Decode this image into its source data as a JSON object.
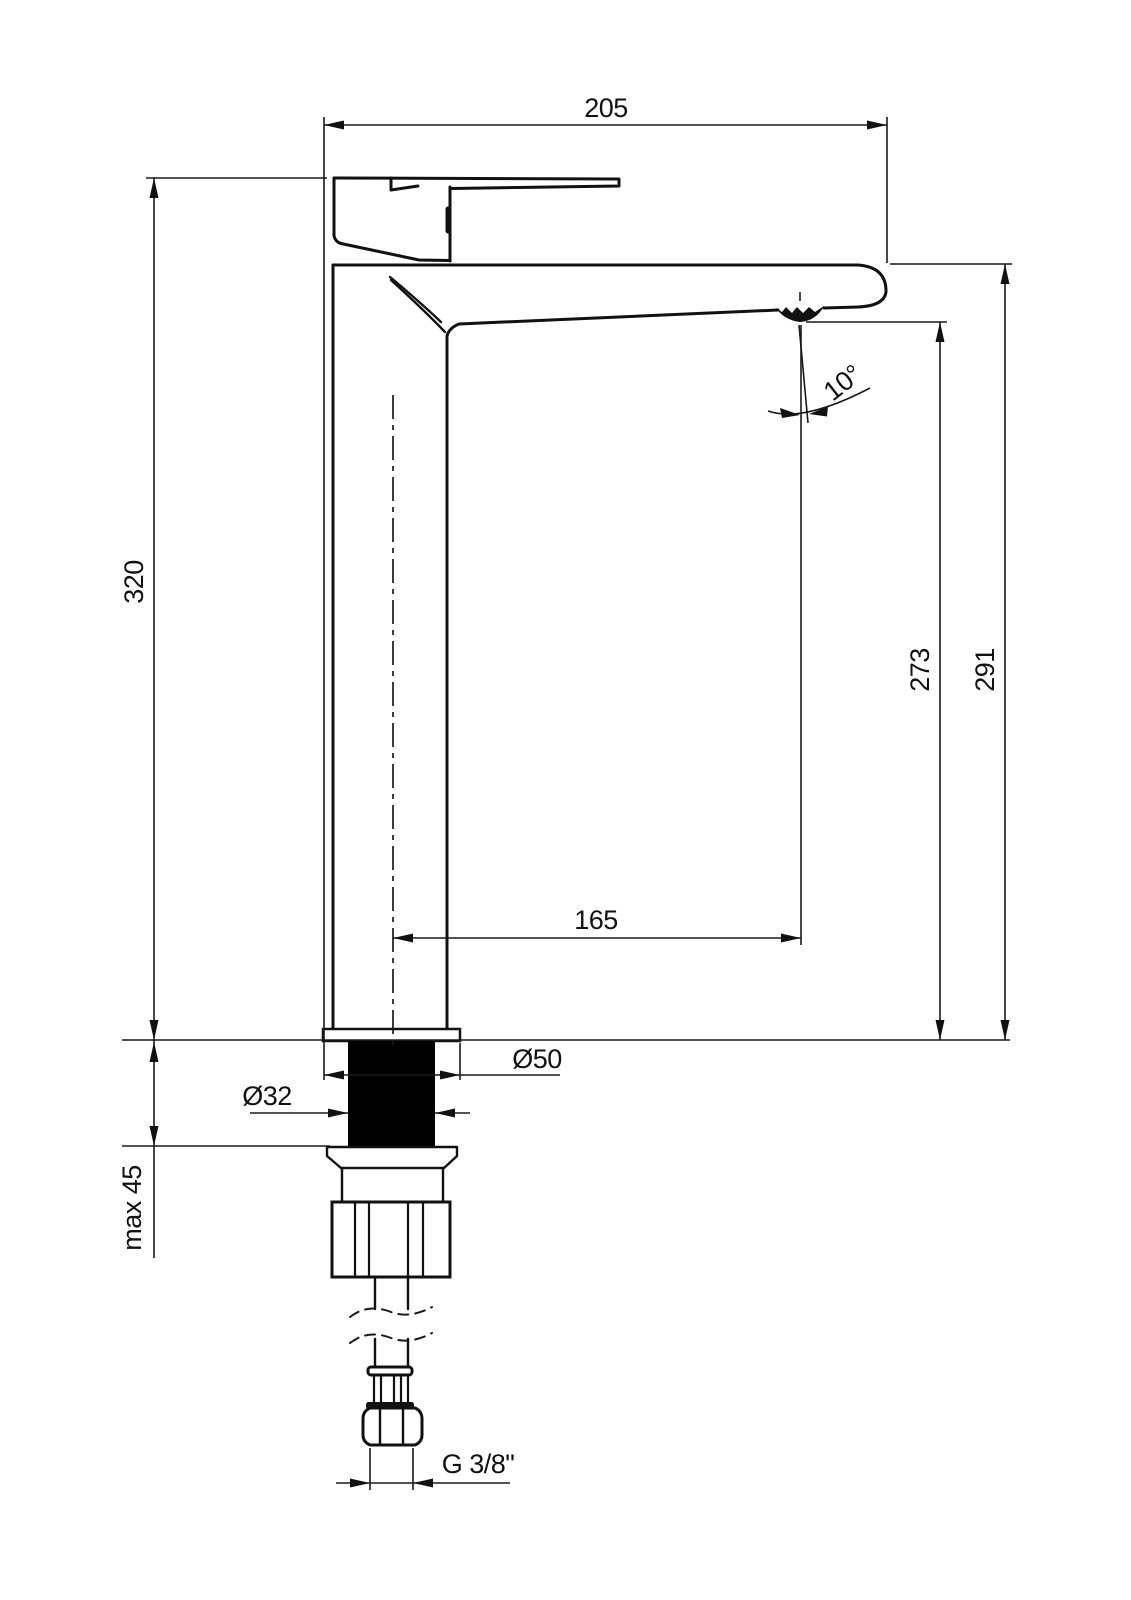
{
  "drawing": {
    "colors": {
      "line": "#111111",
      "background": "#ffffff"
    },
    "labels": {
      "width_top": "205",
      "height_body": "320",
      "spout_angle": "10°",
      "height_aerator": "273",
      "height_total": "291",
      "spout_reach": "165",
      "base_diameter": "Ø50",
      "shank_diameter": "Ø32",
      "max_mounting_depth": "max 45",
      "connection_thread": "G 3/8\""
    }
  }
}
